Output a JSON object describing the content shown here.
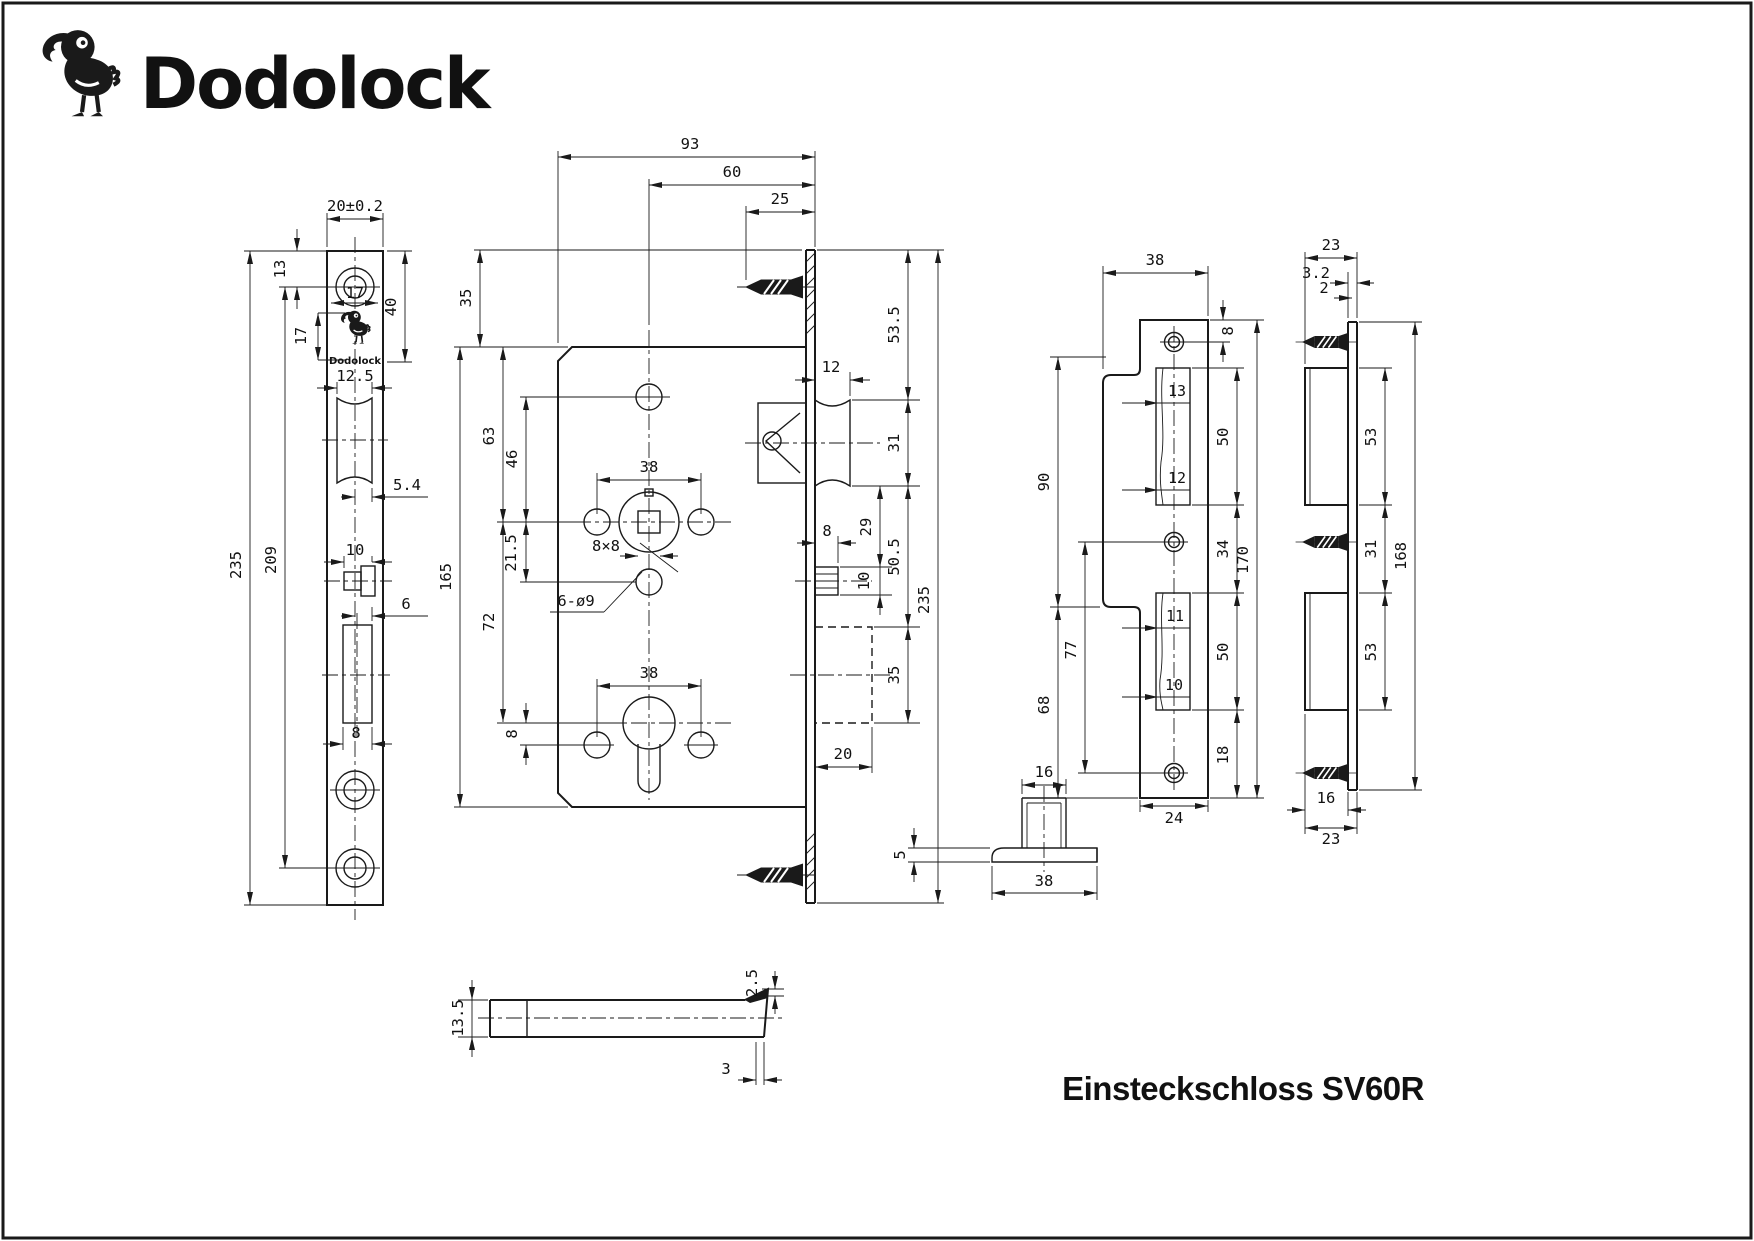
{
  "brand": {
    "name": "Dodolock"
  },
  "drawing_title": "Einsteckschloss SV60R",
  "faceplate": {
    "plate_brand": "Dodolock",
    "d": {
      "width": "20±0.2",
      "screw_top": "13",
      "hole": "17",
      "logo_h": "17",
      "head": "40",
      "latch_w": "12.5",
      "latch_off": "5.4",
      "pin_w": "10",
      "bolt_off": "6",
      "bolt_w": "8",
      "screw_span": "209",
      "length": "235"
    }
  },
  "body": {
    "d": {
      "width": "93",
      "backset": "60",
      "screw": "25",
      "head": "35",
      "height": "165",
      "c63": "63",
      "c46": "46",
      "c21_5": "21.5",
      "c72": "72",
      "c8": "8",
      "spindle_span": "38",
      "square": "8×8",
      "holes": "6-ø9",
      "cyl_span": "38",
      "c53_5": "53.5",
      "latch_throw": "12",
      "latch_h": "31",
      "c29": "29",
      "pin_w": "8",
      "pin_h": "10",
      "c50_5": "50.5",
      "bolt_h": "35",
      "bolt_throw": "20",
      "length": "235"
    }
  },
  "strike": {
    "d": {
      "width": "38",
      "top": "8",
      "t13": "13",
      "t12": "12",
      "cut1": "50",
      "mid": "34",
      "cut2": "50",
      "bottom": "18",
      "length": "170",
      "foot": "24",
      "c90": "90",
      "c77": "77",
      "c68": "68",
      "t11": "11",
      "t10": "10"
    }
  },
  "strike_side": {
    "d": {
      "emboss": "3.2",
      "thick": "2",
      "top_w": "23",
      "box1": "53",
      "gap": "31",
      "box2": "53",
      "length": "168",
      "box_w": "16",
      "bottom_w": "23"
    }
  },
  "latch": {
    "d": {
      "height": "13.5",
      "bevel": "2.5",
      "tip": "3"
    }
  },
  "guide": {
    "d": {
      "top_w": "16",
      "thick": "5",
      "base_w": "38"
    }
  }
}
